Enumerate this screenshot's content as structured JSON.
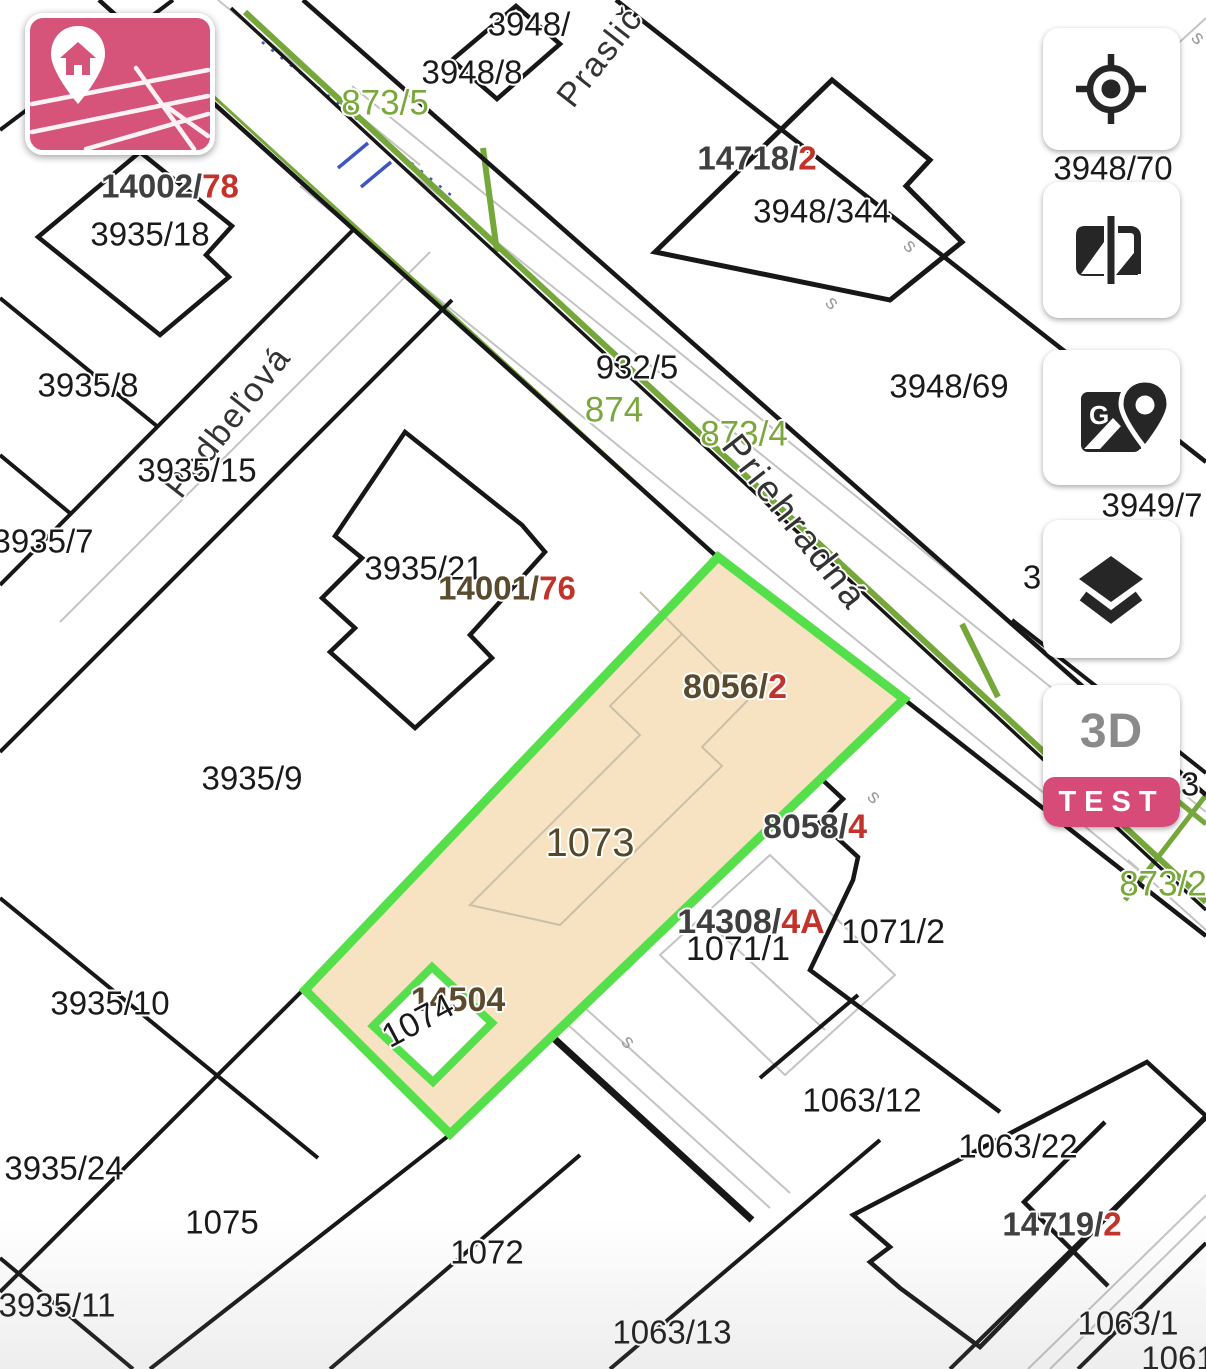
{
  "colors": {
    "highlight_fill": "#f7e3c2",
    "highlight_border": "#55e04b",
    "road_green": "#76a73b",
    "parcel_line": "#171717",
    "faint_line": "#c4c4c4",
    "inner_building_line": "#cbbfa6",
    "utility_blue": "#3f55c4",
    "minimap_pink": "#d6547a",
    "badge_pink": "#d64b78",
    "label_black": "#1a1a1a",
    "label_brown": "#5a4a2e",
    "label_gray": "#3f3f3f",
    "label_red": "#c2332b",
    "label_green": "#7aa83c",
    "street_gray": "#333333"
  },
  "controls": {
    "minimap": {
      "name": "minimap-button",
      "icon": "map-pin-house-icon"
    },
    "toolbar": {
      "locate": {
        "icon": "locate-crosshair-icon"
      },
      "compare": {
        "icon": "compare-layers-icon"
      },
      "gmaps": {
        "icon": "google-maps-icon"
      },
      "layers": {
        "icon": "layers-icon"
      },
      "view3d": {
        "label": "3D",
        "badge": "TEST"
      }
    }
  },
  "map": {
    "highlighted_parcel": "1073",
    "labels": [
      {
        "name": "parcel-3948",
        "parts": [
          {
            "t": "3948/",
            "c": "#1a1a1a"
          }
        ],
        "x": 529,
        "y": 24,
        "fs": 33
      },
      {
        "name": "parcel-3948-8",
        "parts": [
          {
            "t": "3948/8",
            "c": "#1a1a1a"
          }
        ],
        "x": 472,
        "y": 72,
        "fs": 33
      },
      {
        "name": "road-873-5",
        "parts": [
          {
            "t": "873/5",
            "c": "#7aa83c"
          }
        ],
        "x": 385,
        "y": 103,
        "fs": 35
      },
      {
        "name": "parcel-14002-78",
        "parts": [
          {
            "t": "14002/",
            "c": "#3f3f3f"
          },
          {
            "t": "78",
            "c": "#c2332b"
          }
        ],
        "x": 170,
        "y": 186,
        "fs": 33,
        "w": 700
      },
      {
        "name": "parcel-3935-18",
        "parts": [
          {
            "t": "3935/18",
            "c": "#1a1a1a"
          }
        ],
        "x": 150,
        "y": 234,
        "fs": 33
      },
      {
        "name": "parcel-14718-2",
        "parts": [
          {
            "t": "14718/",
            "c": "#3f3f3f"
          },
          {
            "t": "2",
            "c": "#c2332b"
          }
        ],
        "x": 757,
        "y": 158,
        "fs": 33,
        "w": 700
      },
      {
        "name": "parcel-3948-344",
        "parts": [
          {
            "t": "3948/344",
            "c": "#1a1a1a"
          }
        ],
        "x": 822,
        "y": 211,
        "fs": 33
      },
      {
        "name": "parcel-3948-70",
        "parts": [
          {
            "t": "3948/70",
            "c": "#1a1a1a"
          }
        ],
        "x": 1113,
        "y": 168,
        "fs": 33
      },
      {
        "name": "parcel-3935-8",
        "parts": [
          {
            "t": "3935/8",
            "c": "#1a1a1a"
          }
        ],
        "x": 88,
        "y": 385,
        "fs": 33
      },
      {
        "name": "parcel-932-5",
        "parts": [
          {
            "t": "932/5",
            "c": "#1a1a1a"
          }
        ],
        "x": 637,
        "y": 367,
        "fs": 33
      },
      {
        "name": "road-874",
        "parts": [
          {
            "t": "874",
            "c": "#7aa83c"
          }
        ],
        "x": 614,
        "y": 410,
        "fs": 35
      },
      {
        "name": "road-873-4",
        "parts": [
          {
            "t": "873/4",
            "c": "#7aa83c"
          }
        ],
        "x": 744,
        "y": 434,
        "fs": 35
      },
      {
        "name": "parcel-3948-69",
        "parts": [
          {
            "t": "3948/69",
            "c": "#1a1a1a"
          }
        ],
        "x": 949,
        "y": 386,
        "fs": 33
      },
      {
        "name": "street-praslickova",
        "parts": [
          {
            "t": "Praslič",
            "c": "#333333"
          }
        ],
        "x": 600,
        "y": 57,
        "fs": 34,
        "rot": -52,
        "ls": 2
      },
      {
        "name": "street-podbelova",
        "parts": [
          {
            "t": "Podbeľová",
            "c": "#333333"
          }
        ],
        "x": 228,
        "y": 422,
        "fs": 34,
        "rot": -52,
        "ls": 2
      },
      {
        "name": "parcel-3935-15",
        "parts": [
          {
            "t": "3935/15",
            "c": "#1a1a1a"
          }
        ],
        "x": 197,
        "y": 470,
        "fs": 33
      },
      {
        "name": "parcel-3935-7",
        "parts": [
          {
            "t": "3935/7",
            "c": "#1a1a1a"
          }
        ],
        "x": 43,
        "y": 541,
        "fs": 33
      },
      {
        "name": "street-priehradna",
        "parts": [
          {
            "t": "Priehradná",
            "c": "#333333"
          }
        ],
        "x": 795,
        "y": 522,
        "fs": 37,
        "rot": 52,
        "ls": 3
      },
      {
        "name": "parcel-3949-7",
        "parts": [
          {
            "t": "3949/7",
            "c": "#1a1a1a"
          }
        ],
        "x": 1152,
        "y": 505,
        "fs": 33
      },
      {
        "name": "parcel-3-partial-a",
        "parts": [
          {
            "t": "3",
            "c": "#1a1a1a"
          }
        ],
        "x": 1032,
        "y": 577,
        "fs": 33
      },
      {
        "name": "parcel-3935-21",
        "parts": [
          {
            "t": "3935/21",
            "c": "#1a1a1a"
          }
        ],
        "x": 424,
        "y": 568,
        "fs": 33
      },
      {
        "name": "parcel-14001-76",
        "parts": [
          {
            "t": "14001/",
            "c": "#5a4a2e"
          },
          {
            "t": "76",
            "c": "#c2332b"
          }
        ],
        "x": 507,
        "y": 588,
        "fs": 33,
        "w": 700
      },
      {
        "name": "parcel-8056-2",
        "parts": [
          {
            "t": "8056/",
            "c": "#5a4a2e"
          },
          {
            "t": "2",
            "c": "#c2332b"
          }
        ],
        "x": 735,
        "y": 687,
        "fs": 34,
        "w": 700
      },
      {
        "name": "parcel-3935-9",
        "parts": [
          {
            "t": "3935/9",
            "c": "#1a1a1a"
          }
        ],
        "x": 252,
        "y": 778,
        "fs": 33
      },
      {
        "name": "parcel-3-partial-b",
        "parts": [
          {
            "t": "3",
            "c": "#1a1a1a"
          }
        ],
        "x": 1190,
        "y": 784,
        "fs": 33
      },
      {
        "name": "parcel-1073",
        "parts": [
          {
            "t": "1073",
            "c": "#55482a"
          }
        ],
        "x": 590,
        "y": 843,
        "fs": 40
      },
      {
        "name": "parcel-8058-4",
        "parts": [
          {
            "t": "8058/",
            "c": "#3f3f3f"
          },
          {
            "t": "4",
            "c": "#c2332b"
          }
        ],
        "x": 815,
        "y": 827,
        "fs": 34,
        "w": 700
      },
      {
        "name": "road-873-2",
        "parts": [
          {
            "t": "873/2",
            "c": "#7aa83c"
          }
        ],
        "x": 1163,
        "y": 884,
        "fs": 35
      },
      {
        "name": "parcel-14308-4A",
        "parts": [
          {
            "t": "14308/",
            "c": "#3f3f3f"
          },
          {
            "t": "4A",
            "c": "#c2332b"
          }
        ],
        "x": 751,
        "y": 922,
        "fs": 34,
        "w": 700
      },
      {
        "name": "parcel-1071-1",
        "parts": [
          {
            "t": "1071/1",
            "c": "#1a1a1a"
          }
        ],
        "x": 738,
        "y": 949,
        "fs": 34
      },
      {
        "name": "parcel-1071-2",
        "parts": [
          {
            "t": "1071/2",
            "c": "#1a1a1a"
          }
        ],
        "x": 893,
        "y": 932,
        "fs": 34
      },
      {
        "name": "parcel-3935-10",
        "parts": [
          {
            "t": "3935/10",
            "c": "#1a1a1a"
          }
        ],
        "x": 110,
        "y": 1003,
        "fs": 33
      },
      {
        "name": "parcel-14504",
        "parts": [
          {
            "t": "14504",
            "c": "#5a4a2e"
          }
        ],
        "x": 458,
        "y": 1000,
        "fs": 34,
        "w": 700
      },
      {
        "name": "parcel-1074",
        "parts": [
          {
            "t": "1074",
            "c": "#1a1a1a"
          }
        ],
        "x": 418,
        "y": 1021,
        "fs": 34,
        "rot": -28
      },
      {
        "name": "parcel-1063-12",
        "parts": [
          {
            "t": "1063/12",
            "c": "#1a1a1a"
          }
        ],
        "x": 862,
        "y": 1100,
        "fs": 33
      },
      {
        "name": "parcel-3935-24",
        "parts": [
          {
            "t": "3935/24",
            "c": "#1a1a1a"
          }
        ],
        "x": 64,
        "y": 1168,
        "fs": 33
      },
      {
        "name": "parcel-1063-22",
        "parts": [
          {
            "t": "1063/22",
            "c": "#1a1a1a"
          }
        ],
        "x": 1018,
        "y": 1146,
        "fs": 33
      },
      {
        "name": "parcel-1075",
        "parts": [
          {
            "t": "1075",
            "c": "#1a1a1a"
          }
        ],
        "x": 222,
        "y": 1222,
        "fs": 33
      },
      {
        "name": "parcel-14719-2",
        "parts": [
          {
            "t": "14719/",
            "c": "#3f3f3f"
          },
          {
            "t": "2",
            "c": "#c2332b"
          }
        ],
        "x": 1062,
        "y": 1224,
        "fs": 33,
        "w": 700
      },
      {
        "name": "parcel-1072",
        "parts": [
          {
            "t": "1072",
            "c": "#1a1a1a"
          }
        ],
        "x": 487,
        "y": 1252,
        "fs": 33
      },
      {
        "name": "parcel-3935-11",
        "parts": [
          {
            "t": "3935/11",
            "c": "#1a1a1a"
          }
        ],
        "x": 57,
        "y": 1305,
        "fs": 33
      },
      {
        "name": "parcel-1063-13",
        "parts": [
          {
            "t": "1063/13",
            "c": "#1a1a1a"
          }
        ],
        "x": 672,
        "y": 1332,
        "fs": 33
      },
      {
        "name": "parcel-1063-1",
        "parts": [
          {
            "t": "1063/1",
            "c": "#1a1a1a"
          }
        ],
        "x": 1128,
        "y": 1323,
        "fs": 33
      },
      {
        "name": "parcel-1061",
        "parts": [
          {
            "t": "1061",
            "c": "#1a1a1a"
          }
        ],
        "x": 1178,
        "y": 1358,
        "fs": 33
      },
      {
        "name": "survey-mark",
        "parts": [
          {
            "t": "s",
            "c": "#9a9a9a"
          }
        ],
        "x": 910,
        "y": 246,
        "fs": 20,
        "rot": 45,
        "halo": false
      },
      {
        "name": "survey-mark",
        "parts": [
          {
            "t": "s",
            "c": "#9a9a9a"
          }
        ],
        "x": 832,
        "y": 303,
        "fs": 20,
        "rot": 45,
        "halo": false
      },
      {
        "name": "survey-mark",
        "parts": [
          {
            "t": "s",
            "c": "#9a9a9a"
          }
        ],
        "x": 874,
        "y": 797,
        "fs": 20,
        "rot": 45,
        "halo": false
      },
      {
        "name": "survey-mark",
        "parts": [
          {
            "t": "s",
            "c": "#9a9a9a"
          }
        ],
        "x": 628,
        "y": 1042,
        "fs": 20,
        "rot": 45,
        "halo": false
      },
      {
        "name": "survey-mark",
        "parts": [
          {
            "t": "s",
            "c": "#9a9a9a"
          }
        ],
        "x": 1198,
        "y": 38,
        "fs": 20,
        "rot": 45,
        "halo": false
      }
    ]
  }
}
